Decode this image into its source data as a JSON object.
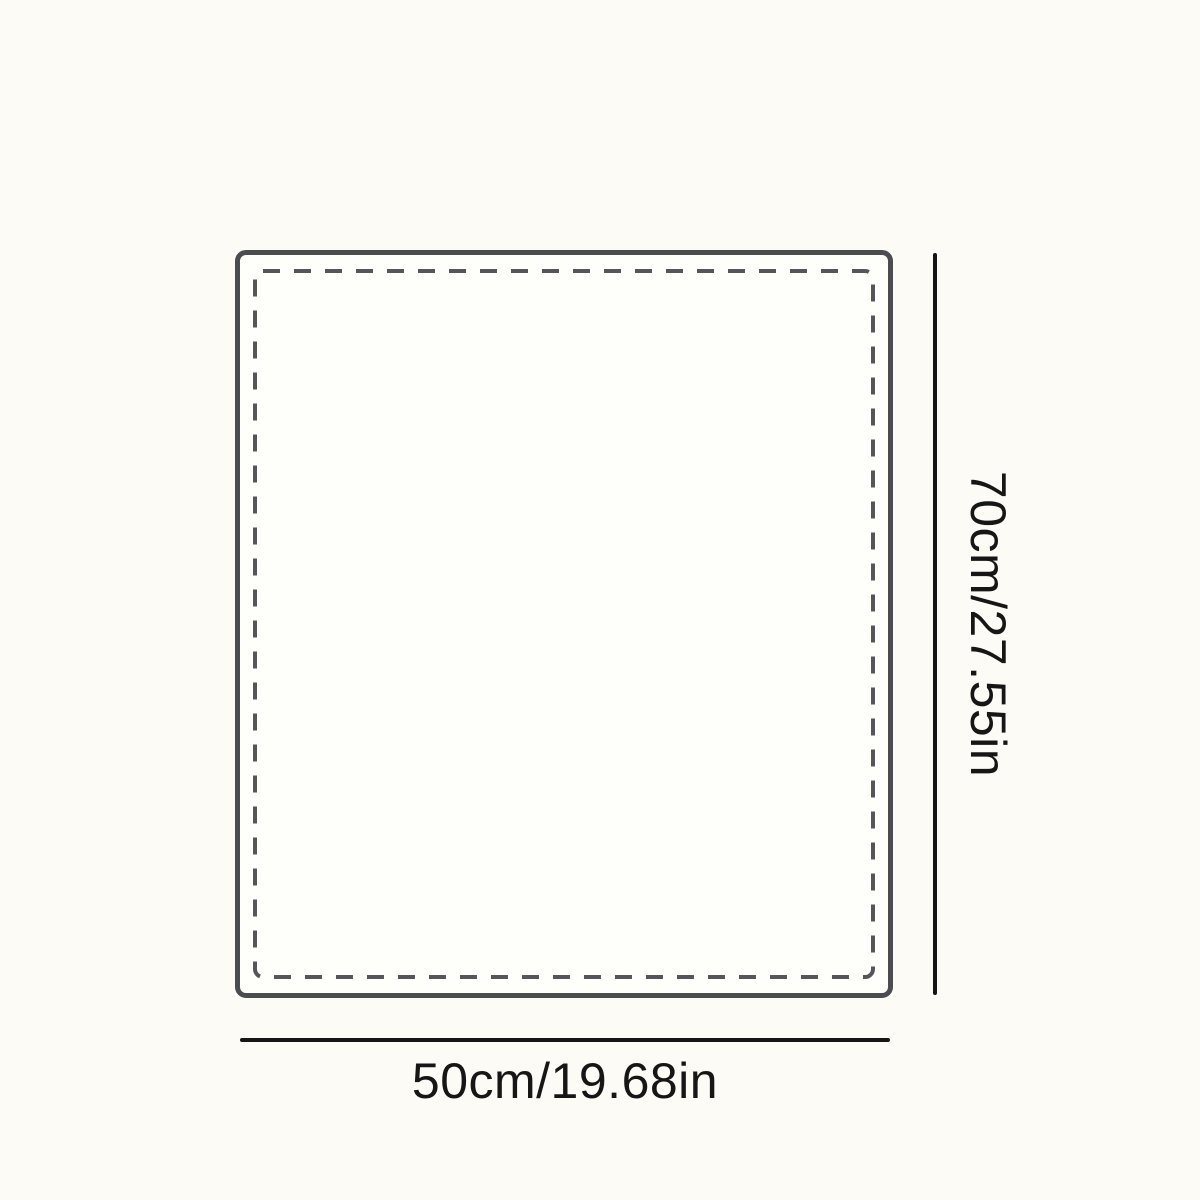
{
  "diagram": {
    "title": "product-size-diagram",
    "height_label": "70cm/27.55in",
    "width_label": "50cm/19.68in"
  },
  "colors": {
    "background": "#fcfbf6",
    "outline": "#4b4c50",
    "stitch": "#55565b",
    "dimension": "#161616"
  },
  "stitch": {
    "dash_pattern": "17 14"
  }
}
